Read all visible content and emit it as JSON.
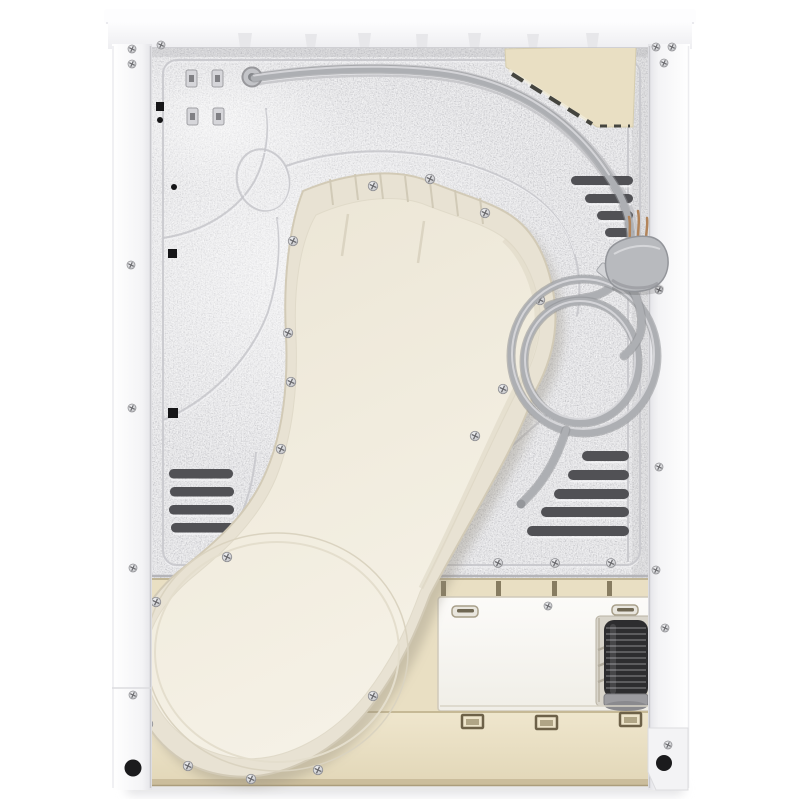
{
  "colors": {
    "background": "#ffffff",
    "top_band": "#fafafb",
    "frame": "#f8f8f9",
    "frame_shade": "#e2e2e6",
    "metal": "#e9e9eb",
    "metal_shade": "#b5b5b9",
    "emboss": "#c6c6ca",
    "emboss_light": "#f3f3f5",
    "vent": "#515155",
    "beige": "#e9dfc3",
    "beige_dark": "#b4a887",
    "plinth": "#efe6cd",
    "plinth_dark": "#cbbd9c",
    "access_panel": "#fbfaf7",
    "panel_border": "#cfc9ba",
    "duct_flange": "#e8e2d3",
    "duct_face": "#f2eddf",
    "duct_edge": "#d2cab6",
    "cord": "#adafb3",
    "cord_dark": "#8e9094",
    "cord_light": "#dadbde",
    "plug": "#b8babe",
    "plug_dark": "#97999d",
    "brass": "#b2845a",
    "hose": "#2d2d2f",
    "hose_ridge": "#77777b",
    "foot": "#1b1b1d",
    "screw_dark": "#7e7e82",
    "mark_black": "#151517",
    "shadow": "#e3e3e5"
  },
  "parts": {
    "vent_louvers_upper_right": 4,
    "vent_louvers_lower_right": 5,
    "vent_louvers_left": 4,
    "plinth_latches": 3,
    "cable_clips": 4,
    "feet_visible": 2,
    "power_plug_style": "3-pin",
    "power_cord_loops": 2
  }
}
